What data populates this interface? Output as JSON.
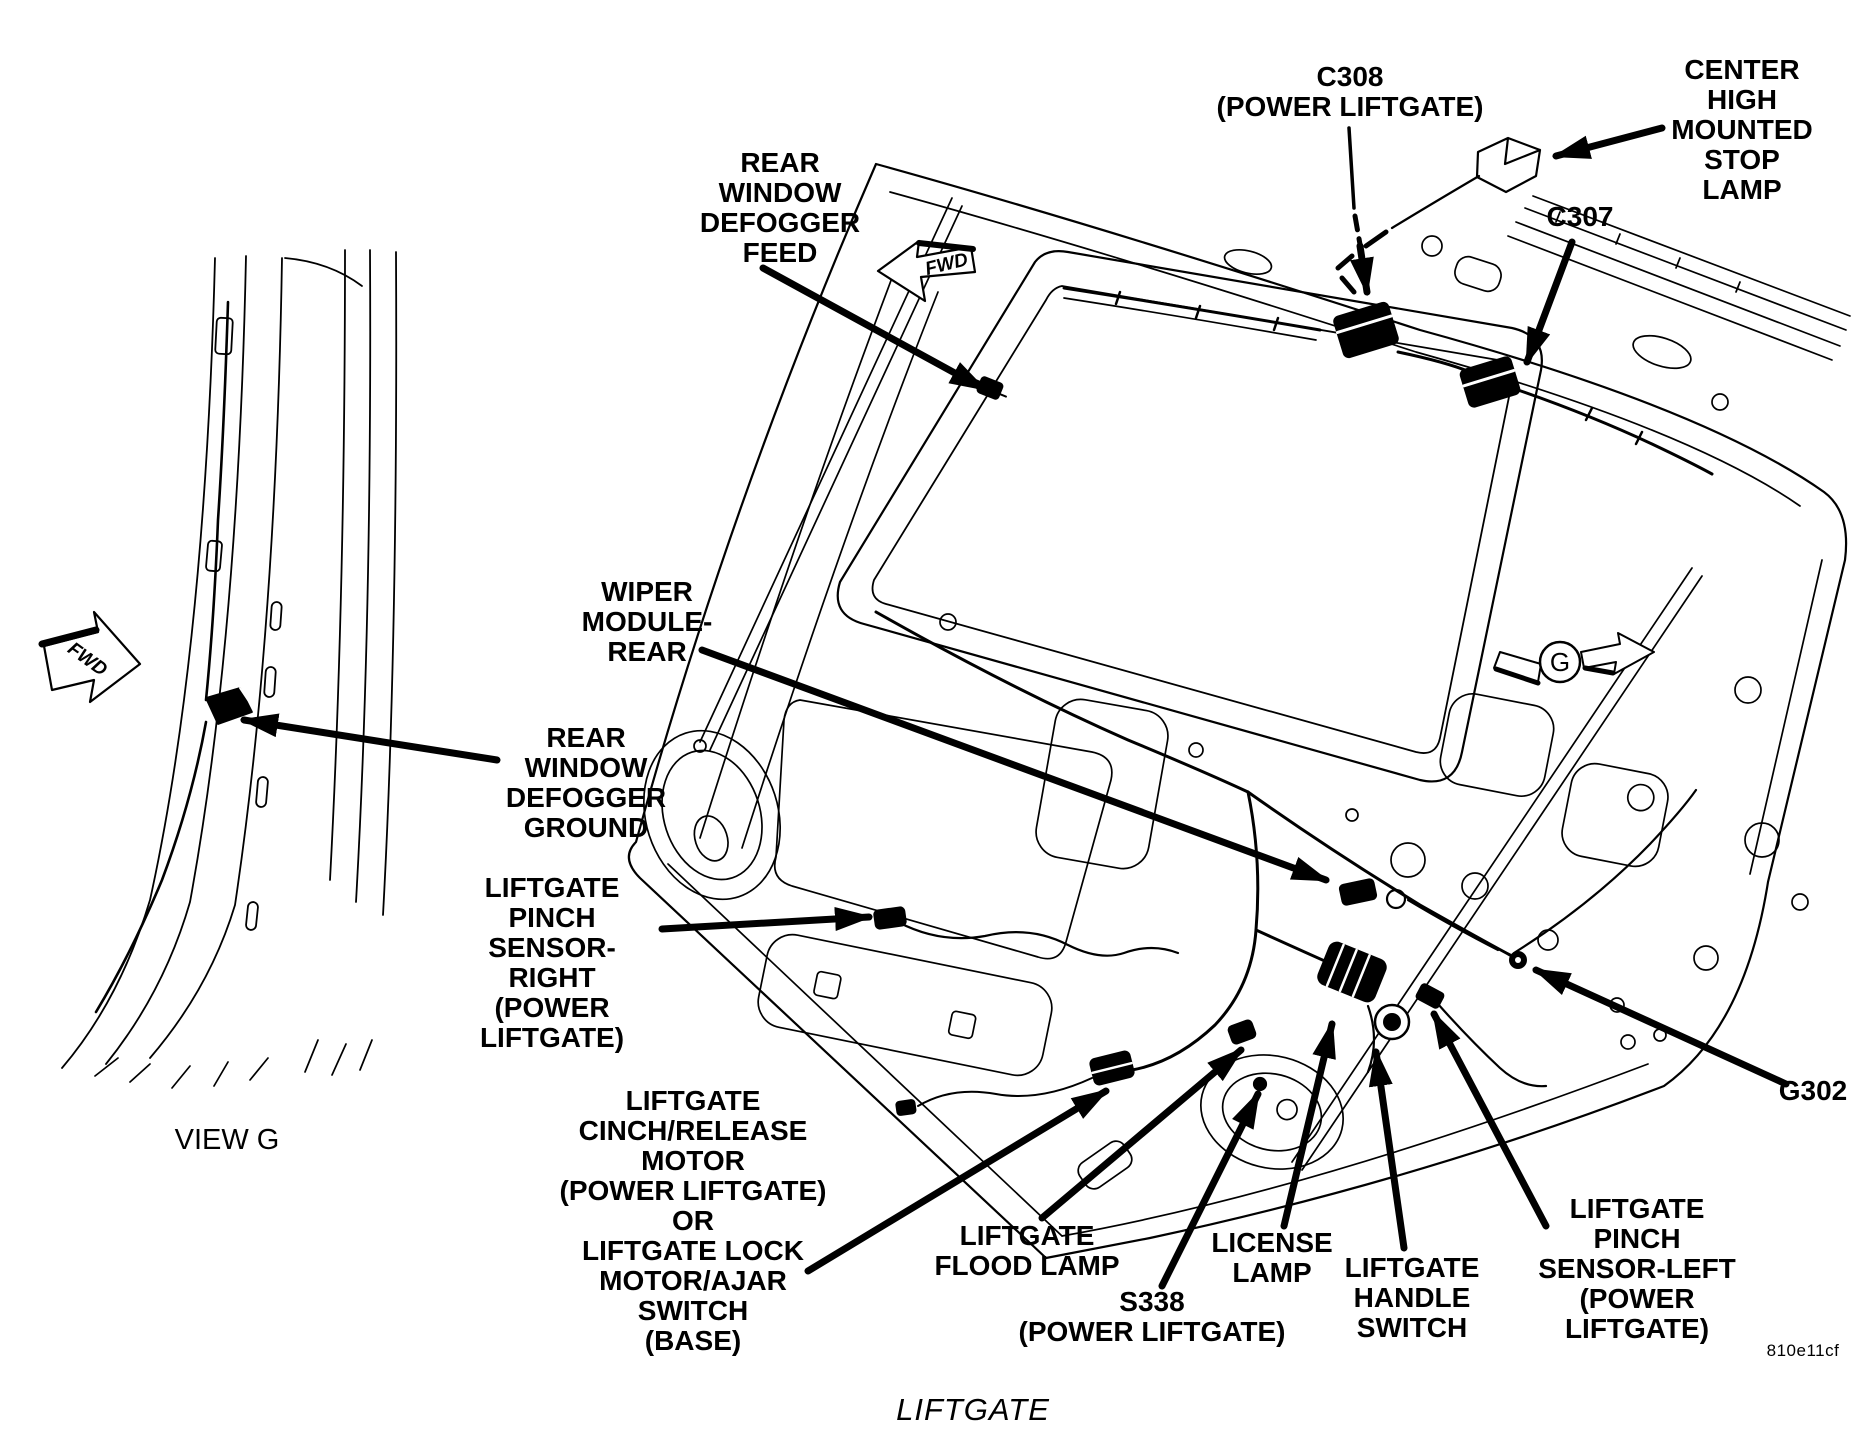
{
  "figure": {
    "title": "LIFTGATE",
    "drawing_code": "810e11cf",
    "view_caption": "VIEW G",
    "fwd_marker": "FWD",
    "g_marker": "G",
    "colors": {
      "ink": "#000000",
      "paper": "#ffffff"
    }
  },
  "labels": {
    "c308": "C308\n(POWER LIFTGATE)",
    "center_high_mounted_stop_lamp": "CENTER\nHIGH\nMOUNTED\nSTOP\nLAMP",
    "c307": "C307",
    "rear_window_defogger_feed": "REAR\nWINDOW\nDEFOGGER\nFEED",
    "wiper_module_rear": "WIPER\nMODULE-\nREAR",
    "rear_window_defogger_ground": "REAR\nWINDOW\nDEFOGGER\nGROUND",
    "liftgate_pinch_sensor_right": "LIFTGATE\nPINCH\nSENSOR-\nRIGHT\n(POWER\nLIFTGATE)",
    "liftgate_cinch_release_motor": "LIFTGATE\nCINCH/RELEASE\nMOTOR\n(POWER LIFTGATE)\nOR\nLIFTGATE LOCK\nMOTOR/AJAR\nSWITCH\n(BASE)",
    "liftgate_flood_lamp": "LIFTGATE\nFLOOD LAMP",
    "s338": "S338\n(POWER LIFTGATE)",
    "license_lamp": "LICENSE\nLAMP",
    "liftgate_handle_switch": "LIFTGATE\nHANDLE\nSWITCH",
    "liftgate_pinch_sensor_left": "LIFTGATE PINCH\nSENSOR-LEFT\n(POWER LIFTGATE)",
    "g302": "G302"
  }
}
